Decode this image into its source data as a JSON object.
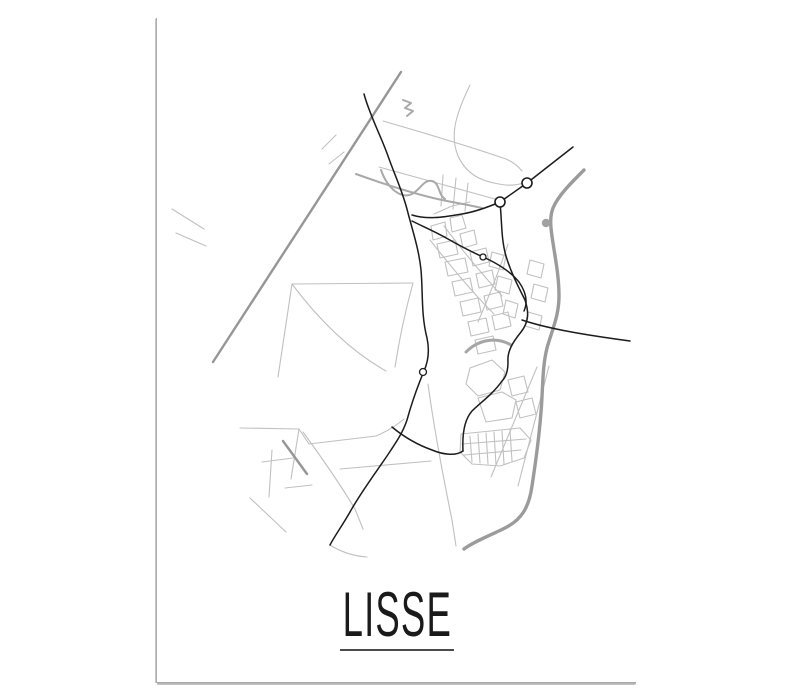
{
  "poster": {
    "title": "LISSE",
    "style": "minimalist black and white city map poster",
    "background": "#ffffff",
    "title_color": "#1a1a1a",
    "underline_color": "#4b4b4b"
  },
  "map": {
    "place": "Lisse",
    "colors": {
      "road_primary": "#1c1c1c",
      "road_secondary": "#969696",
      "road_bypass": "#9b9b9b",
      "road_minor": "#c0c0c0",
      "water": "#a9a9a9",
      "node_fill": "#ffffff"
    },
    "layers": [
      {
        "name": "minor-street",
        "color": "#c0c0c0",
        "width": 1.1,
        "paths": [
          "M470,85 C457,112 449,134 458,156 C466,173 479,181 499,184 C508,186 517,185 523,183",
          "M383,121 C428,134 468,146 506,159 C513,162 518,166 522,171",
          "M379,167 C420,178 458,189 495,199",
          "M443,175 L441,206",
          "M456,178 L453,209",
          "M468,183 L465,211",
          "M278,377 L292,284 L413,283",
          "M292,284 C322,324 354,353 386,371",
          "M413,283 C405,312 399,341 395,367",
          "M240,428 L299,429 L309,444 L376,436",
          "M299,429 L291,479",
          "M376,436 C388,431 397,425 404,419",
          "M303,432 C322,458 340,484 355,509 L363,529",
          "M340,469 L431,461",
          "M428,384 C434,428 443,476 452,520 L456,546",
          "M537,367 L491,477",
          "M549,366 L518,486",
          "M262,462 L293,458",
          "M272,450 L269,497",
          "M285,488 L312,485",
          "M250,498 L286,532",
          "M330,545 C341,552 353,556 367,557",
          "M336,135 L322,149",
          "M344,152 L329,164",
          "M172,209 L204,229",
          "M176,233 L206,246",
          "M431,226 L445,222 L447,236 L433,240 Z",
          "M450,218 L462,215 L466,228 L452,232 Z",
          "M437,244 L455,240 L458,254 L440,258 Z",
          "M460,234 L474,230 L477,244 L463,248 Z",
          "M445,262 L465,258 L468,272 L448,276 Z",
          "M470,252 L486,248 L489,262 L473,266 Z",
          "M492,252 L506,256 L503,270 L489,266 Z",
          "M452,282 L470,278 L473,292 L455,296 Z",
          "M476,274 L492,270 L495,284 L479,288 Z",
          "M498,276 L512,280 L509,294 L495,290 Z",
          "M460,302 L478,298 L481,312 L463,316 Z",
          "M484,296 L500,292 L503,306 L487,310 Z",
          "M506,300 L518,304 L515,318 L503,314 Z",
          "M468,322 L486,318 L489,332 L471,336 Z",
          "M492,316 L508,312 L511,326 L495,330 Z",
          "M475,340 L493,336 L496,350 L478,354 Z",
          "M530,260 L544,264 L541,278 L527,274 Z",
          "M534,284 L548,288 L545,302 L531,298 Z",
          "M528,312 L542,316 L539,330 L525,326 Z",
          "M430,240 C452,268 472,292 494,314",
          "M444,226 C462,250 482,274 502,296",
          "M508,244 C500,268 490,294 478,322",
          "M434,214 L452,206 L470,202",
          "M470,368 L492,360 L505,372 L500,390 L478,396 L466,384 Z",
          "M478,398 L502,392 L516,400 L512,418 L486,422 Z",
          "M508,380 L524,376 L528,392 L512,396 Z",
          "M516,402 L532,398 L536,414 L520,418 Z",
          "M461,434 L520,428 L531,440 L524,458 L500,466 L472,464 L460,452 Z",
          "M470,436 L472,462",
          "M478,434 L480,463",
          "M486,433 L488,464",
          "M494,432 L496,465",
          "M502,431 L504,464",
          "M510,430 L512,461",
          "M462,444 L526,439",
          "M464,455 L521,450"
        ]
      },
      {
        "name": "water-stream",
        "color": "#a9a9a9",
        "width": 2,
        "paths": [
          "M381,170 C388,190 402,199 412,194 C420,190 424,179 432,181 C440,183 438,195 445,199",
          "M403,100 L411,103 L405,108 L413,111 L407,116",
          "M356,174 C392,187 424,197 452,202 C463,204 473,206 482,208"
        ]
      },
      {
        "name": "canal",
        "color": "#a6a6a6",
        "width": 3,
        "paths": [
          "M466,352 C478,340 496,336 511,345"
        ]
      },
      {
        "name": "secondary-road",
        "color": "#969696",
        "width": 2.4,
        "paths": [
          "M401,72 L213,362",
          "M283,441 L307,474"
        ]
      },
      {
        "name": "bypass-road",
        "color": "#9b9b9b",
        "width": 3.4,
        "paths": [
          "M584,170 C570,184 558,196 553,208 C549,218 551,230 553,243 C556,262 559,278 559,296 C559,316 552,330 547,348 C542,368 543,390 541,412 C539,438 536,460 532,486 C529,508 521,520 505,528 C489,536 473,542 464,549"
        ]
      },
      {
        "name": "primary-road",
        "color": "#1c1c1c",
        "width": 1.5,
        "paths": [
          "M364,94 C370,116 381,136 388,156 C395,176 403,192 408,213 C413,232 419,250 421,270 C423,292 421,315 427,338 C430,352 428,362 424,371 C419,383 413,398 407,420 C403,432 397,441 389,453 C377,471 361,492 350,512 C342,526 334,537 330,545",
          "M573,147 L527,183 L500,202",
          "M500,202 C486,208 474,212 462,214 C444,217 428,220 412,215",
          "M500,203 C502,221 501,239 506,256 C511,273 519,288 525,300 C529,312 529,322 521,332 C513,342 507,351 508,362 C508,371 506,377 502,381 C493,394 480,403 472,411 C465,419 462,432 463,451",
          "M392,427 C404,437 418,445 432,450 C444,455 456,456 463,451",
          "M412,221 C424,227 436,232 448,239 C462,247 472,252 483,257 C497,263 511,272 519,282 C526,292 528,302 524,311",
          "M522,320 C546,328 578,334 630,341"
        ]
      }
    ],
    "water_dot": {
      "cx": 546,
      "cy": 223,
      "r": 4.2,
      "fill": "#a2a2a2"
    },
    "roundabouts": [
      {
        "cx": 527,
        "cy": 183,
        "r": 5,
        "stroke_width": 1.6
      },
      {
        "cx": 500,
        "cy": 202,
        "r": 5,
        "stroke_width": 1.6
      },
      {
        "cx": 483,
        "cy": 257,
        "r": 3,
        "stroke_width": 1.3
      },
      {
        "cx": 423,
        "cy": 372,
        "r": 3.5,
        "stroke_width": 1.3
      }
    ]
  }
}
